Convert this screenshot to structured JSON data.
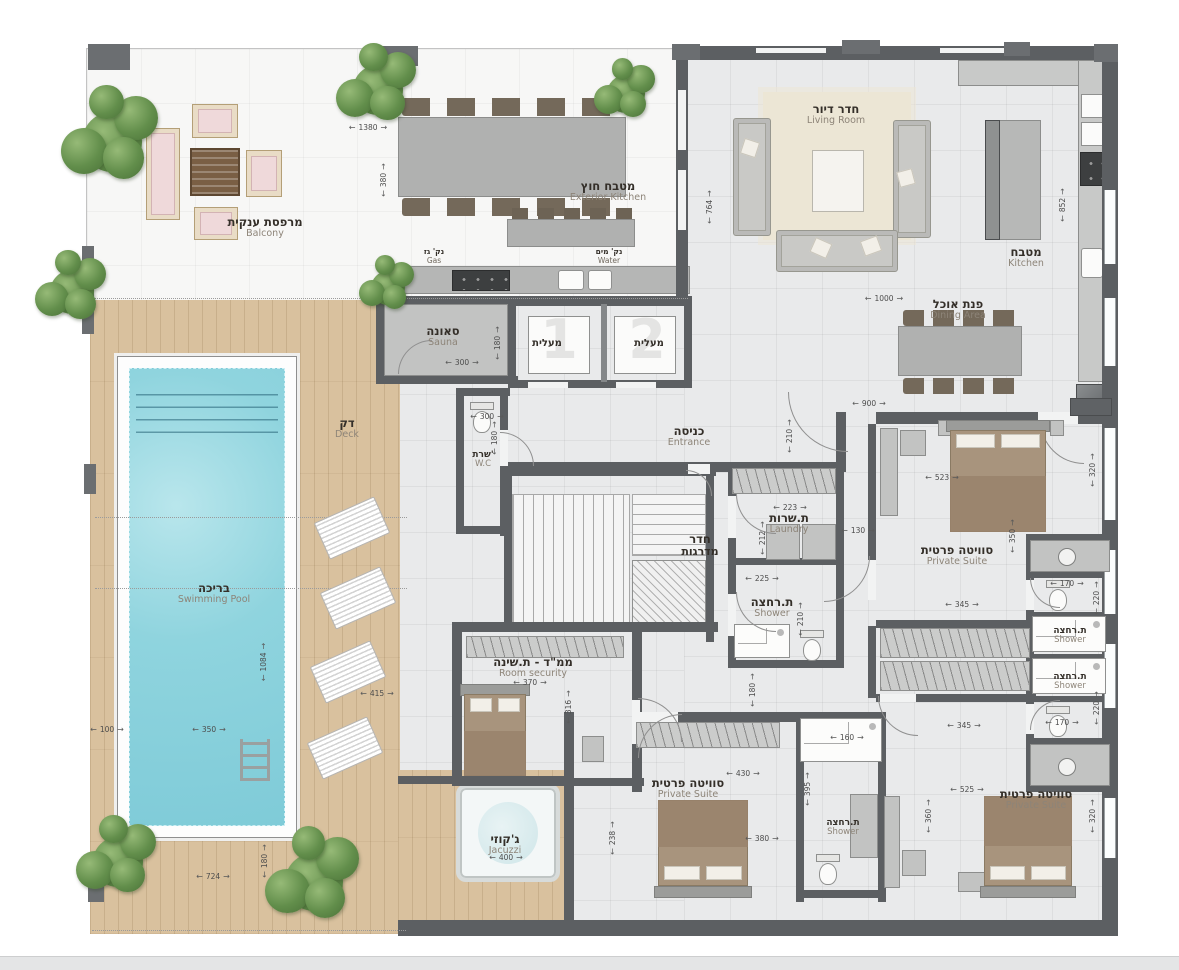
{
  "labels": [
    {
      "id": "balcony",
      "he": "מרפסת ענקית",
      "en": "Balcony",
      "x": 265,
      "y": 228
    },
    {
      "id": "exterior-kitchen",
      "he": "מטבח חוץ",
      "en": "Exterior Kitchen",
      "x": 608,
      "y": 192
    },
    {
      "id": "gas-point",
      "he": "נק' גז",
      "en": "Gas",
      "x": 434,
      "y": 260,
      "s": "point"
    },
    {
      "id": "water-point",
      "he": "נק' מים",
      "en": "Water",
      "x": 609,
      "y": 260,
      "s": "point"
    },
    {
      "id": "living-room",
      "he": "חדר דיור",
      "en": "Living Room",
      "x": 836,
      "y": 115
    },
    {
      "id": "kitchen",
      "he": "מטבח",
      "en": "Kitchen",
      "x": 1026,
      "y": 258
    },
    {
      "id": "dining-area",
      "he": "פנת אוכל",
      "en": "Dining Area",
      "x": 958,
      "y": 310
    },
    {
      "id": "sauna",
      "he": "סאונה",
      "en": "Sauna",
      "x": 443,
      "y": 337
    },
    {
      "id": "elevator-1",
      "he": "מעלית",
      "x": 547,
      "y": 350,
      "s": "small"
    },
    {
      "id": "elevator-2",
      "he": "מעלית",
      "x": 649,
      "y": 350,
      "s": "small"
    },
    {
      "id": "entrance",
      "he": "כניסה",
      "en": "Entrance",
      "x": 689,
      "y": 437
    },
    {
      "id": "wc",
      "he": "שרת'",
      "en": "W.C",
      "x": 483,
      "y": 462,
      "s": "small2"
    },
    {
      "id": "deck",
      "he": "דק",
      "en": "Deck",
      "x": 347,
      "y": 429
    },
    {
      "id": "swimming-pool",
      "he": "בריכה",
      "en": "Swimming Pool",
      "x": 214,
      "y": 594
    },
    {
      "id": "stairs",
      "he": "חדר",
      "en": "מדרגות",
      "x": 700,
      "y": 545,
      "s": "he2"
    },
    {
      "id": "laundry",
      "he": "ת.שרות",
      "en": "Laundry",
      "x": 789,
      "y": 524
    },
    {
      "id": "shower-center",
      "he": "ת.רחצה",
      "en": "Shower",
      "x": 772,
      "y": 608
    },
    {
      "id": "suite-top-right",
      "he": "סוויטה פרטית",
      "en": "Private Suite",
      "x": 957,
      "y": 556
    },
    {
      "id": "shower-right-1",
      "he": "ת.רחצה",
      "en": "Shower",
      "x": 1070,
      "y": 638,
      "s": "small2"
    },
    {
      "id": "shower-right-2",
      "he": "ת.רחצה",
      "en": "Shower",
      "x": 1070,
      "y": 684,
      "s": "small2"
    },
    {
      "id": "room-security",
      "he": "ממ\"ד - ת.שינה",
      "en": "Room security",
      "x": 533,
      "y": 668
    },
    {
      "id": "jacuzzi",
      "he": "ג'קוזי",
      "en": "Jacuzzi",
      "x": 505,
      "y": 845
    },
    {
      "id": "suite-bottom-middle",
      "he": "סוויטה פרטית",
      "en": "Private Suite",
      "x": 688,
      "y": 789
    },
    {
      "id": "shower-bottom",
      "he": "ת.רחצה",
      "en": "Shower",
      "x": 843,
      "y": 830,
      "s": "small2"
    },
    {
      "id": "suite-bottom-right",
      "he": "סוויטה פרטית",
      "en": "Private Suite",
      "x": 1036,
      "y": 800
    }
  ],
  "dims": [
    {
      "t": "1380",
      "x": 368,
      "y": 127,
      "d": "h"
    },
    {
      "t": "380",
      "x": 383,
      "y": 180,
      "d": "v"
    },
    {
      "t": "764",
      "x": 709,
      "y": 207,
      "d": "v"
    },
    {
      "t": "852",
      "x": 1062,
      "y": 205,
      "d": "v"
    },
    {
      "t": "1000",
      "x": 884,
      "y": 298,
      "d": "h"
    },
    {
      "t": "900",
      "x": 869,
      "y": 403,
      "d": "h"
    },
    {
      "t": "210",
      "x": 789,
      "y": 436,
      "d": "v"
    },
    {
      "t": "300",
      "x": 462,
      "y": 362,
      "d": "h"
    },
    {
      "t": "180",
      "x": 497,
      "y": 343,
      "d": "v"
    },
    {
      "t": "300",
      "x": 487,
      "y": 416,
      "d": "h"
    },
    {
      "t": "180",
      "x": 494,
      "y": 438,
      "d": "v"
    },
    {
      "t": "1084",
      "x": 263,
      "y": 662,
      "d": "v"
    },
    {
      "t": "350",
      "x": 209,
      "y": 729,
      "d": "h"
    },
    {
      "t": "100",
      "x": 107,
      "y": 729,
      "d": "h"
    },
    {
      "t": "415",
      "x": 377,
      "y": 693,
      "d": "h"
    },
    {
      "t": "724",
      "x": 213,
      "y": 876,
      "d": "h"
    },
    {
      "t": "180",
      "x": 264,
      "y": 861,
      "d": "v"
    },
    {
      "t": "223",
      "x": 790,
      "y": 507,
      "d": "h"
    },
    {
      "t": "212",
      "x": 762,
      "y": 538,
      "d": "v"
    },
    {
      "t": "225",
      "x": 762,
      "y": 578,
      "d": "h"
    },
    {
      "t": "210",
      "x": 800,
      "y": 619,
      "d": "v"
    },
    {
      "t": "130",
      "x": 858,
      "y": 530,
      "d": "h"
    },
    {
      "t": "523",
      "x": 942,
      "y": 477,
      "d": "h"
    },
    {
      "t": "320",
      "x": 1092,
      "y": 470,
      "d": "v"
    },
    {
      "t": "350",
      "x": 1012,
      "y": 536,
      "d": "v"
    },
    {
      "t": "345",
      "x": 962,
      "y": 604,
      "d": "h"
    },
    {
      "t": "170",
      "x": 1067,
      "y": 583,
      "d": "h"
    },
    {
      "t": "220",
      "x": 1096,
      "y": 598,
      "d": "v"
    },
    {
      "t": "180",
      "x": 752,
      "y": 690,
      "d": "v"
    },
    {
      "t": "370",
      "x": 530,
      "y": 682,
      "d": "h"
    },
    {
      "t": "316",
      "x": 568,
      "y": 707,
      "d": "v"
    },
    {
      "t": "238",
      "x": 612,
      "y": 838,
      "d": "v"
    },
    {
      "t": "430",
      "x": 743,
      "y": 773,
      "d": "h"
    },
    {
      "t": "380",
      "x": 762,
      "y": 838,
      "d": "h"
    },
    {
      "t": "345",
      "x": 964,
      "y": 725,
      "d": "h"
    },
    {
      "t": "525",
      "x": 967,
      "y": 789,
      "d": "h"
    },
    {
      "t": "360",
      "x": 928,
      "y": 816,
      "d": "v"
    },
    {
      "t": "320",
      "x": 1092,
      "y": 816,
      "d": "v"
    },
    {
      "t": "160",
      "x": 847,
      "y": 737,
      "d": "h"
    },
    {
      "t": "395",
      "x": 807,
      "y": 789,
      "d": "v"
    },
    {
      "t": "170",
      "x": 1062,
      "y": 722,
      "d": "h"
    },
    {
      "t": "220",
      "x": 1096,
      "y": 708,
      "d": "v"
    },
    {
      "t": "400",
      "x": 506,
      "y": 857,
      "d": "h"
    }
  ],
  "elevator_numbers": [
    "1",
    "2"
  ]
}
